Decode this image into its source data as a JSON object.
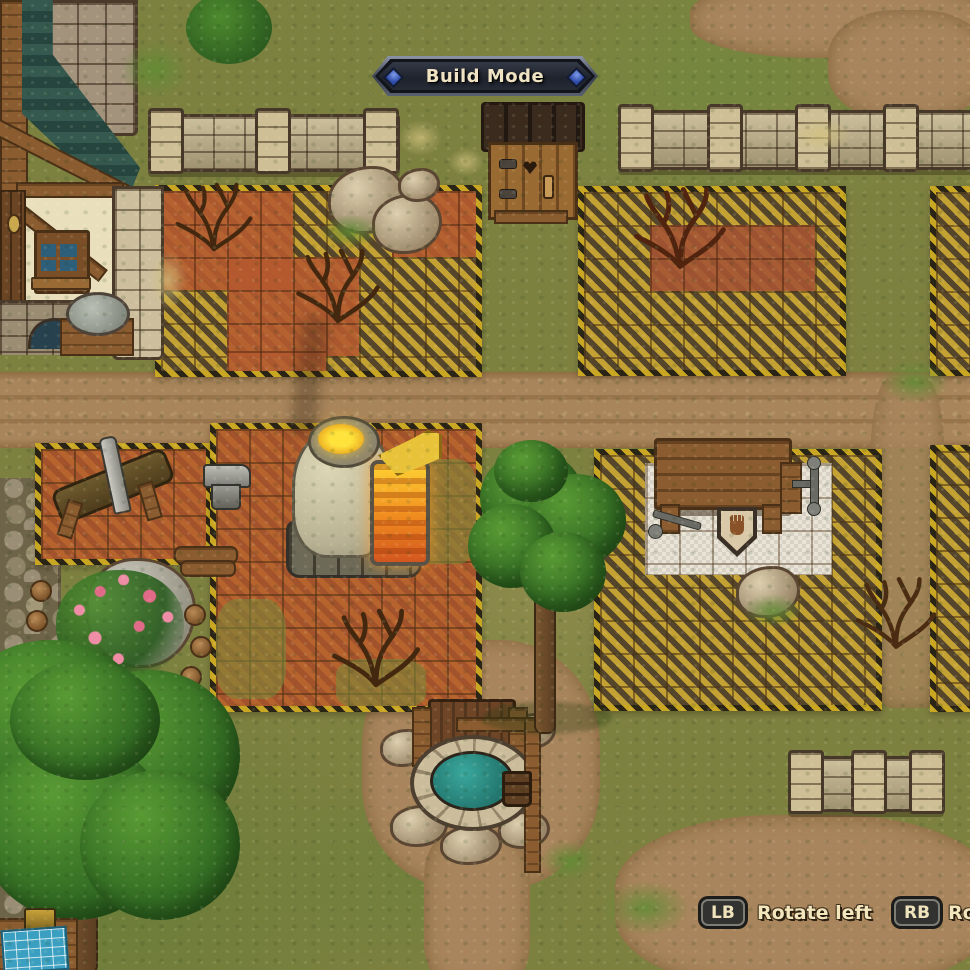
{
  "banner": {
    "title": "Build Mode"
  },
  "hints": {
    "left": {
      "key": "LB",
      "label": "Rotate left"
    },
    "right": {
      "key": "RB",
      "label": "Ro"
    }
  },
  "palette": {
    "hazard_yellow": "#c9a722",
    "hazard_black": "#2a2416",
    "red_tile": "#b45a30",
    "grass": "#7d8140",
    "dirt": "#a8855c",
    "wall_stone": "#c2b28a",
    "roof_teal": "#35594f",
    "water": "#2f8c86",
    "furnace_glow": "#ffd832",
    "ui_text": "#f3e6bd",
    "keycap_bg": "#323230",
    "banner_bg": "#23262e",
    "gem_blue": "#3f63c8"
  },
  "world_objects": [
    "house",
    "stone-chimney",
    "outhouse",
    "stone-fence",
    "build-zone",
    "furnace",
    "bellows",
    "saw-log",
    "anvil",
    "workbench",
    "vise",
    "hand-sign",
    "well",
    "bucket-post",
    "tree",
    "dead-bush",
    "boulder",
    "rose-bush",
    "cobblestone-path",
    "blueprint-table",
    "grindstone"
  ]
}
